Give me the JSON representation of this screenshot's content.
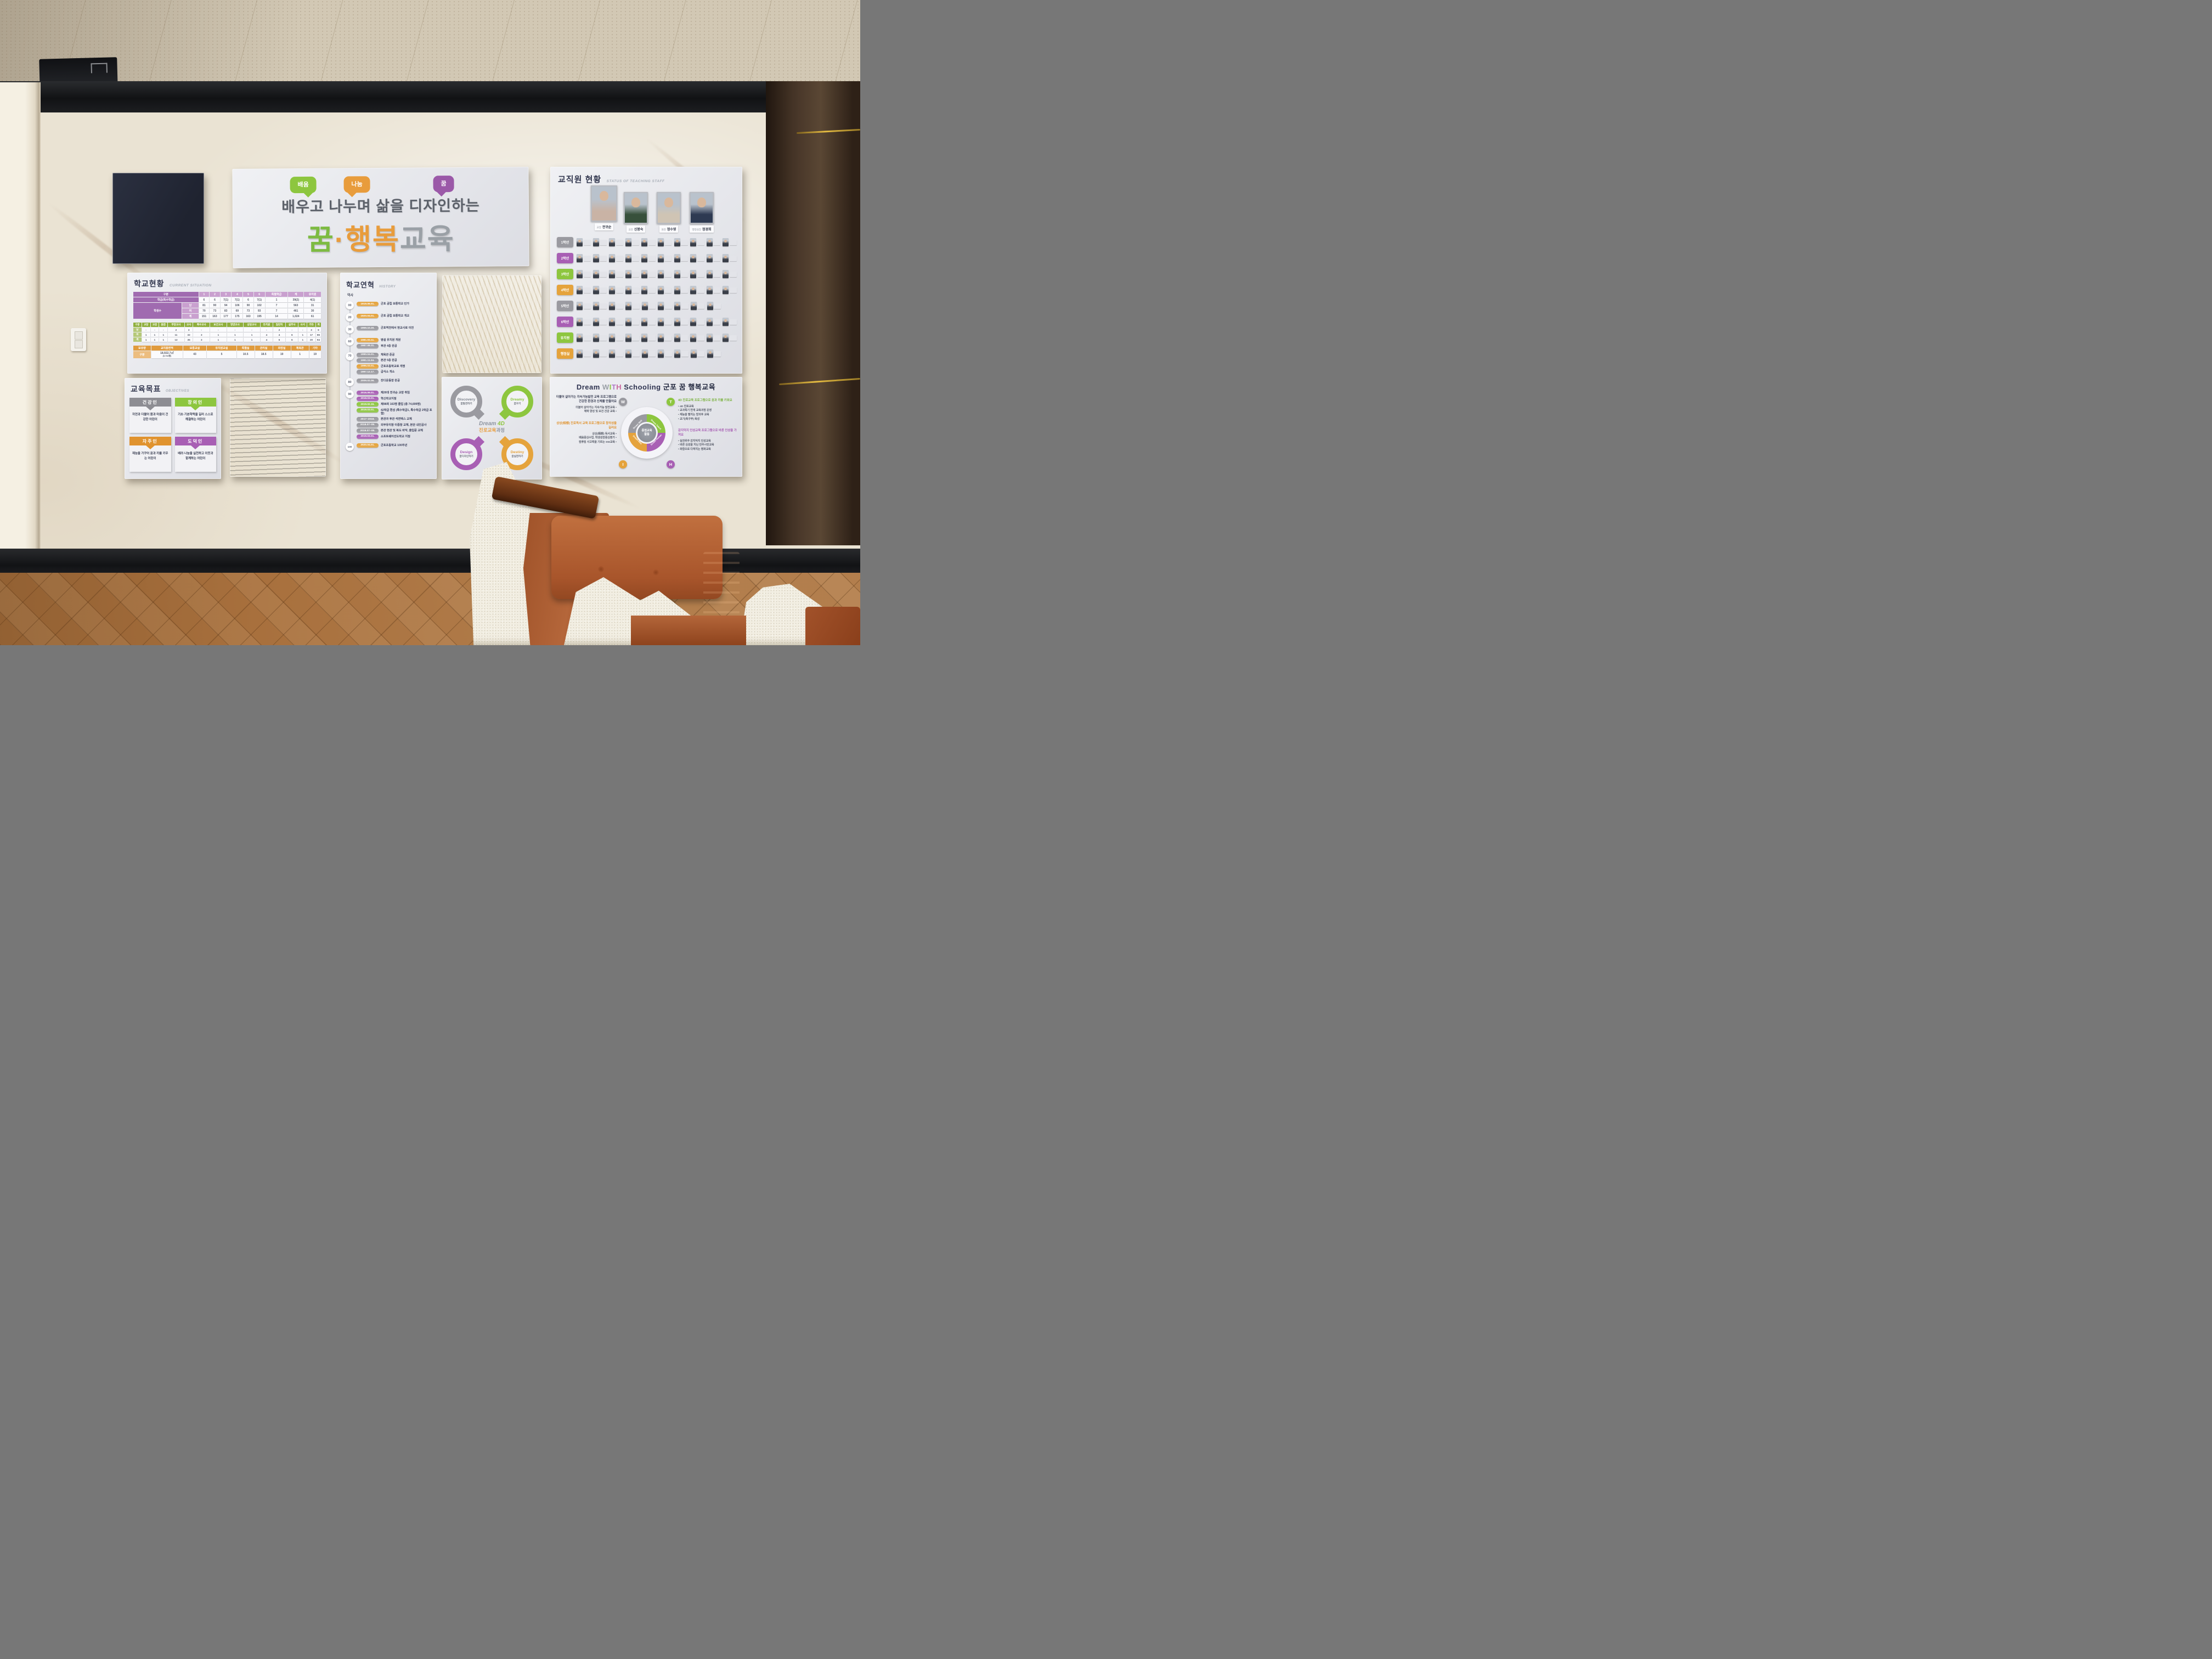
{
  "banner": {
    "bubbles": [
      {
        "label": "배움",
        "color": "#8dc63f",
        "tail": "r"
      },
      {
        "label": "나눔",
        "color": "#e89c3c",
        "tail": "l"
      },
      {
        "label": "꿈",
        "color": "#9b59a8",
        "tail": "l"
      }
    ],
    "line1": "배우고 나누며 삶을 디자인하는",
    "line2_parts": [
      {
        "text": "꿈",
        "color": "#7dbb42"
      },
      {
        "text": "·",
        "color": "#e89c3c"
      },
      {
        "text": "행복",
        "color": "#e89c3c"
      },
      {
        "text": "교육",
        "color": "#9aa0a6"
      }
    ]
  },
  "staff_board": {
    "title": "교직원 현황",
    "subtitle": "STATUS OF TEACHING STAFF",
    "leaders": [
      {
        "role": "교장",
        "name": "전귀순"
      },
      {
        "role": "교감",
        "name": "신봉숙"
      },
      {
        "role": "원감",
        "name": "정수영"
      },
      {
        "role": "행정실장",
        "name": "정경희"
      }
    ],
    "rows": [
      {
        "label": "1학년",
        "color": "#9a9aa0",
        "count": 10
      },
      {
        "label": "2학년",
        "color": "#a85fb4",
        "count": 10
      },
      {
        "label": "3학년",
        "color": "#8dc63f",
        "count": 10
      },
      {
        "label": "4학년",
        "color": "#e5a33c",
        "count": 10
      },
      {
        "label": "5학년",
        "color": "#9a9aa0",
        "count": 9
      },
      {
        "label": "6학년",
        "color": "#a85fb4",
        "count": 10
      },
      {
        "label": "유치원",
        "color": "#8dc63f",
        "count": 10
      },
      {
        "label": "행정실",
        "color": "#e5a33c",
        "count": 9
      }
    ]
  },
  "current_situation": {
    "title": "학교현황",
    "subtitle": "CURRENT SITUATION",
    "class_table": {
      "header": [
        "구분",
        "1",
        "2",
        "3",
        "4",
        "5",
        "6",
        "특별학급",
        "계",
        "유치원"
      ],
      "class_row": {
        "label": "학급(특수학급)",
        "values": [
          "6",
          "6",
          "7(1)",
          "7(1)",
          "6",
          "7(1)",
          "1",
          "39(2)",
          "4(1)"
        ]
      },
      "group_label": "학생수",
      "group_rows": [
        {
          "label": "남",
          "values": [
            "81",
            "90",
            "94",
            "106",
            "90",
            "102",
            "7",
            "563",
            "31"
          ]
        },
        {
          "label": "여",
          "values": [
            "70",
            "73",
            "83",
            "69",
            "73",
            "93",
            "7",
            "461",
            "30"
          ]
        },
        {
          "label": "계",
          "values": [
            "151",
            "163",
            "177",
            "175",
            "163",
            "195",
            "14",
            "1,024",
            "61"
          ]
        }
      ]
    },
    "staff_table": {
      "header": [
        "구분",
        "교장",
        "교감",
        "원감",
        "부장교사",
        "교사",
        "특수교사",
        "보건교사",
        "영양교사",
        "상담교사",
        "유치원",
        "일반직",
        "실무사",
        "사서",
        "기타",
        "계"
      ],
      "rows": [
        {
          "label": "남",
          "values": [
            "-",
            "-",
            "-",
            "2",
            "3",
            "-",
            "-",
            "-",
            "-",
            "-",
            "2",
            "-",
            "-",
            "3",
            "9"
          ]
        },
        {
          "label": "여",
          "values": [
            "1",
            "1",
            "1",
            "11",
            "32",
            "3",
            "1",
            "1",
            "1",
            "4",
            "4",
            "6",
            "1",
            "17",
            "86"
          ]
        },
        {
          "label": "계",
          "values": [
            "1",
            "1",
            "1",
            "13",
            "35",
            "3",
            "1",
            "1",
            "1",
            "4",
            "6",
            "6",
            "1",
            "20",
            "94"
          ]
        }
      ]
    },
    "facility_table": {
      "header": [
        "보유량",
        "교지총면적",
        "보통교실",
        "유치원교실",
        "특별실",
        "관리실",
        "화장실",
        "체육관",
        "기타"
      ],
      "row_label": "구분",
      "area_main": "18,922.7㎡",
      "area_sub": "(5,734평)",
      "values": [
        "43",
        "5",
        "10.5",
        "18.5",
        "19",
        "1",
        "19"
      ]
    }
  },
  "history": {
    "title": "학교연혁",
    "subtitle": "HISTORY",
    "axis_label": "역사",
    "groups": [
      {
        "node": "00",
        "events": [
          {
            "date": "1919.06.01.",
            "color": "orange",
            "text": "군포 공립 보통학교 인가"
          }
        ]
      },
      {
        "node": "20",
        "events": [
          {
            "date": "1920.04.01.",
            "color": "orange",
            "text": "군포 공립 보통학교 개교"
          }
        ]
      },
      {
        "node": "30",
        "events": [
          {
            "date": "1959.10.20.",
            "color": "gray",
            "text": "군포역전에서 현교사로 이전"
          }
        ]
      },
      {
        "node": "60",
        "events": [
          {
            "date": "1981.03.11.",
            "color": "orange",
            "text": "병설 유치원 개원"
          },
          {
            "date": "1987.08.31.",
            "color": "gray",
            "text": "후관 4층 완공"
          }
        ]
      },
      {
        "node": "70",
        "events": [
          {
            "date": "1990.04.01.",
            "color": "gray",
            "text": "체육관 준공"
          },
          {
            "date": "1991.11.04.",
            "color": "gray",
            "text": "본관 5층 완공"
          },
          {
            "date": "1996.03.01.",
            "color": "orange",
            "text": "군포초등학교로 개명"
          },
          {
            "date": "1997.12.17.",
            "color": "gray",
            "text": "급식소 개소"
          }
        ]
      },
      {
        "node": "80",
        "events": [
          {
            "date": "2009.02.06.",
            "color": "gray",
            "text": "잔디운동장 완공"
          }
        ]
      },
      {
        "node": "90",
        "events": [
          {
            "date": "2016.09.01.",
            "color": "purple",
            "text": "제26대 전귀순 교장 취임"
          },
          {
            "date": "2018.03.01.",
            "color": "purple",
            "text": "혁신학교지정"
          },
          {
            "date": "2019.02.15.",
            "color": "green",
            "text": "제98회 163명 졸업 (총 74,699명)"
          },
          {
            "date": "2019.03.01.",
            "color": "green",
            "text": "42학급 편성 (특수학급1, 특수학급 2학급 포함)"
          },
          {
            "date": "2017~2018.",
            "color": "gray",
            "text": "본관과 후관 석면텍스 교체"
          },
          {
            "date": "2018.07~09.",
            "color": "gray",
            "text": "외부유리창 이중창 교체, 본관 내진공사"
          },
          {
            "date": "2019.07~08.",
            "color": "gray",
            "text": "본관 현관 및 복도 바닥, 출입문 교체"
          },
          {
            "date": "2019.03.01.",
            "color": "purple",
            "text": "소프트웨어선도학교 지정"
          }
        ]
      },
      {
        "node": "100",
        "events": [
          {
            "date": "2020.04.01.",
            "color": "orange",
            "text": "군포초등학교 100주년"
          }
        ]
      }
    ]
  },
  "objectives": {
    "title": "교육목표",
    "subtitle": "OBJECTIVES",
    "items": [
      {
        "name": "건강인",
        "color": "#8d8d93",
        "desc": "자연과 더불어 몸과 마음이 건강한 어린이"
      },
      {
        "name": "창의인",
        "color": "#8dc63f",
        "desc": "기초·기본학력을 길러 스스로 해결하는 어린이"
      },
      {
        "name": "자주인",
        "color": "#e0932f",
        "desc": "재능을 가꾸어 꿈과 끼를 키우는 어린이"
      },
      {
        "name": "도덕인",
        "color": "#a85fb4",
        "desc": "배려·나눔을 실천하고 이웃과 함께하는 어린이"
      }
    ]
  },
  "dream4d": {
    "center_parts": [
      {
        "text": "Dream ",
        "color": "#8d94a0"
      },
      {
        "text": "4D",
        "color": "#8dc63f"
      }
    ],
    "center_sub_parts": [
      {
        "text": "진로교육",
        "color": "#e89c3c"
      },
      {
        "text": "과정",
        "color": "#8d94a0"
      }
    ],
    "circles": [
      {
        "en": "Discovery",
        "ko": "꿈발견하기",
        "color": "#9a9aa0",
        "tail": "br"
      },
      {
        "en": "Dreamy",
        "ko": "꿈꾸기",
        "color": "#8dc63f",
        "tail": "bl"
      },
      {
        "en": "Design",
        "ko": "꿈디자인하기",
        "color": "#a85fb4",
        "tail": "tr"
      },
      {
        "en": "Destiny",
        "ko": "꿈실현하기",
        "color": "#e5a33c",
        "tail": "tl"
      }
    ]
  },
  "with_board": {
    "title_parts": [
      {
        "text": "Dream ",
        "color": "#2e3350"
      },
      {
        "text": "W",
        "color": "#9aa0a6"
      },
      {
        "text": "I",
        "color": "#8dc63f"
      },
      {
        "text": "T",
        "color": "#b07cc6"
      },
      {
        "text": "H",
        "color": "#c9699e"
      },
      {
        "text": " Schooling ",
        "color": "#2e3350"
      },
      {
        "text": "군포 꿈 행복교육",
        "color": "#20263c"
      }
    ],
    "sections": [
      {
        "letter": "W",
        "color": "#9a9aa0",
        "headline_color": "#3e4358",
        "side": "left",
        "headline": "더불어 살아가는 지속가능발전 교육 프로그램으로 건강한 환경과 신체를 만들어요",
        "bullets": [
          "더불어 살아가는 지속가능 발전교육",
          "체력 양성 및 보건 건강 교육"
        ]
      },
      {
        "letter": "I",
        "color": "#e5a33c",
        "headline_color": "#e0932f",
        "side": "left",
        "headline": "상상(相想) 진로독서 교육 프로그램으로 창의성을 길러요",
        "bullets": [
          "상상(相想) 독서교육",
          "배움중심수업, 학생성장중심평가",
          "컴퓨팅 사고력을 기르는 SW교육"
        ]
      },
      {
        "letter": "T",
        "color": "#8dc63f",
        "headline_color": "#7cb342",
        "side": "right",
        "headline": "4D 진로교육 프로그램으로 꿈과 끼를 키워요",
        "bullets": [
          "4D 진로교육",
          "교과특기 연계 교육과정 운영",
          "재능을 펼치는 방과후 교육",
          "교기(축구부) 육성"
        ]
      },
      {
        "letter": "H",
        "color": "#a85fb4",
        "headline_color": "#a85fb4",
        "side": "right",
        "headline": "감지덕지 인성교육 프로그램으로 바른 인성을 가져요",
        "bullets": [
          "실천위주 감지덕지 인성교육",
          "바른 심성을 지닌 민주시민교육",
          "화합으로 다져지는 평화교육"
        ]
      }
    ],
    "diagram": {
      "center_line1": "중점교육",
      "center_line2": "활동",
      "segments": [
        {
          "label": "Dream Well",
          "color": "#9a9aa0"
        },
        {
          "label": "Dream Talent",
          "color": "#8dc63f"
        },
        {
          "label": "Dream Human",
          "color": "#a85fb4"
        },
        {
          "label": "Dream Idea",
          "color": "#e5a33c"
        }
      ]
    }
  },
  "palette": {
    "orange": "#e5a33c",
    "gray": "#9a9aa0",
    "purple": "#a85fb4",
    "green": "#8dc63f"
  }
}
